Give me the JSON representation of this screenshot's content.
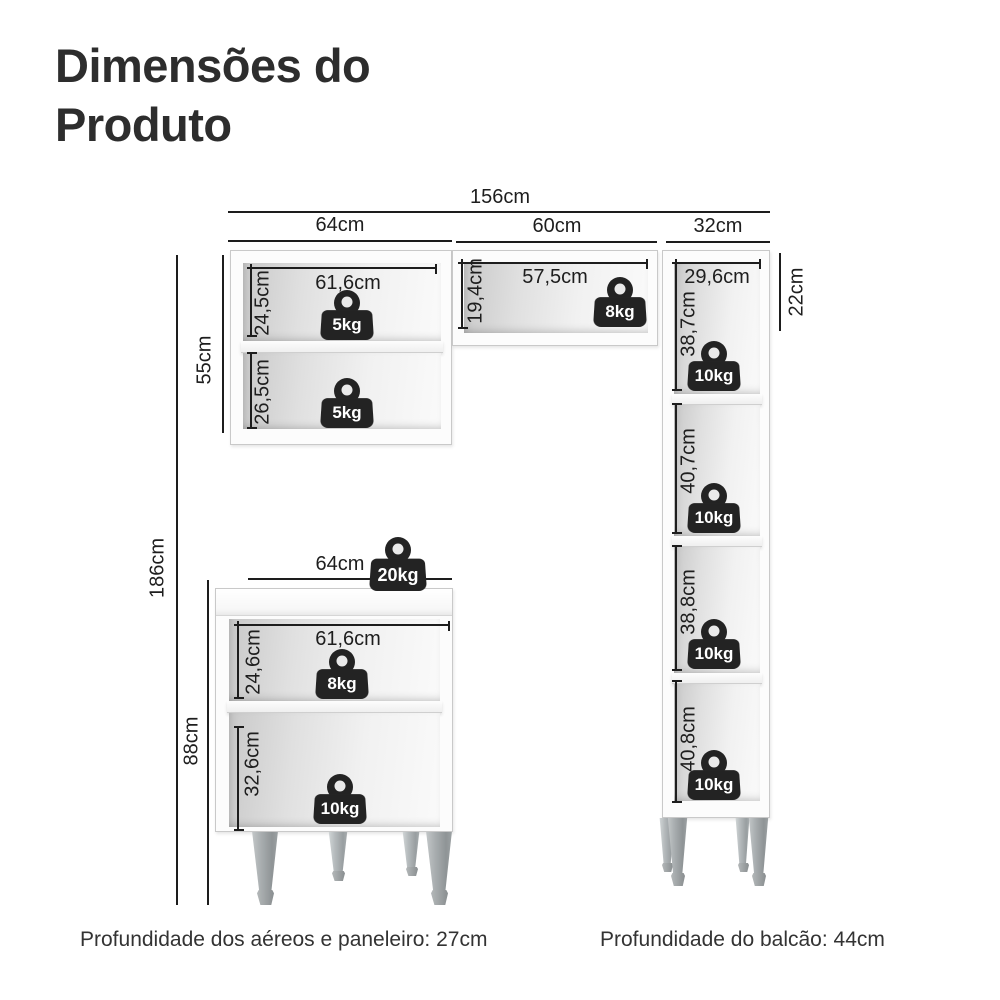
{
  "title": {
    "line1": "Dimensões do",
    "line2": "Produto"
  },
  "footer": {
    "aereos_depth": "Profundidade dos aéreos e paneleiro: 27cm",
    "balcao_depth": "Profundidade do balcão: 44cm"
  },
  "dims": {
    "total_width": "156cm",
    "upper_cabinet_width": "64cm",
    "shelf_width": "60cm",
    "tall_cabinet_width": "32cm",
    "upper_cabinet_height": "55cm",
    "total_height": "186cm",
    "base_cabinet_height": "88cm",
    "shelf_unit_height": "22cm",
    "upper_inner_width": "61,6cm",
    "upper_top_compartment": "24,5cm",
    "upper_bottom_compartment": "26,5cm",
    "shelf_inner_height": "19,4cm",
    "shelf_inner_width": "57,5cm",
    "tall_inner_width": "29,6cm",
    "tall_compartment_1": "38,7cm",
    "tall_compartment_2": "40,7cm",
    "tall_compartment_3": "38,8cm",
    "tall_compartment_4": "40,8cm",
    "base_width": "64cm",
    "base_inner_width": "61,6cm",
    "base_top_compartment": "24,6cm",
    "base_bottom_compartment": "32,6cm"
  },
  "weights": {
    "upper_top": "5kg",
    "upper_bottom": "5kg",
    "shelf": "8kg",
    "tall_1": "10kg",
    "tall_2": "10kg",
    "tall_3": "10kg",
    "tall_4": "10kg",
    "base_top": "20kg",
    "base_middle": "8kg",
    "base_bottom": "10kg"
  },
  "colors": {
    "line": "#1d1d1d",
    "text": "#2d2d2d",
    "weight_icon": "#232323",
    "furniture_edge": "#c9c9c9",
    "leg": "#9aa0a2"
  }
}
